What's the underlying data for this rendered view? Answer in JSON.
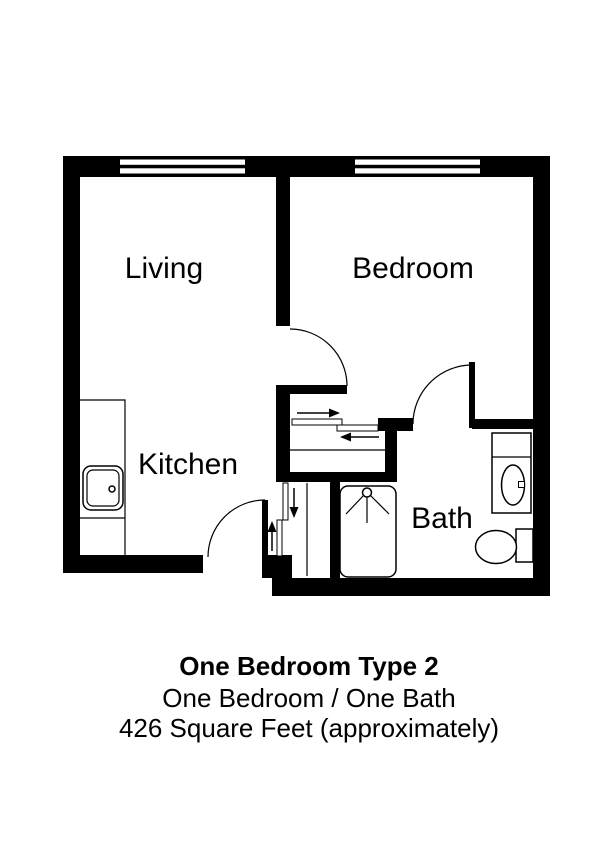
{
  "page": {
    "background_color": "#ffffff",
    "ink_color": "#000000"
  },
  "floorplan": {
    "rooms": {
      "living": "Living",
      "bedroom": "Bedroom",
      "kitchen": "Kitchen",
      "bath": "Bath"
    },
    "features": {
      "windows": [
        "living-window",
        "bedroom-window"
      ],
      "doors": [
        "entry-door",
        "living-hall-door",
        "bath-door"
      ],
      "closets": [
        "bedroom-closet-bypass-doors",
        "entry-closet-bypass-doors"
      ],
      "fixtures": [
        "kitchen-counter",
        "kitchen-sink",
        "shower-stall",
        "toilet",
        "vanity-sink"
      ]
    }
  },
  "caption": {
    "title": "One Bedroom Type 2",
    "subtitle": "One Bedroom / One Bath",
    "area": "426 Square Feet (approximately)"
  }
}
